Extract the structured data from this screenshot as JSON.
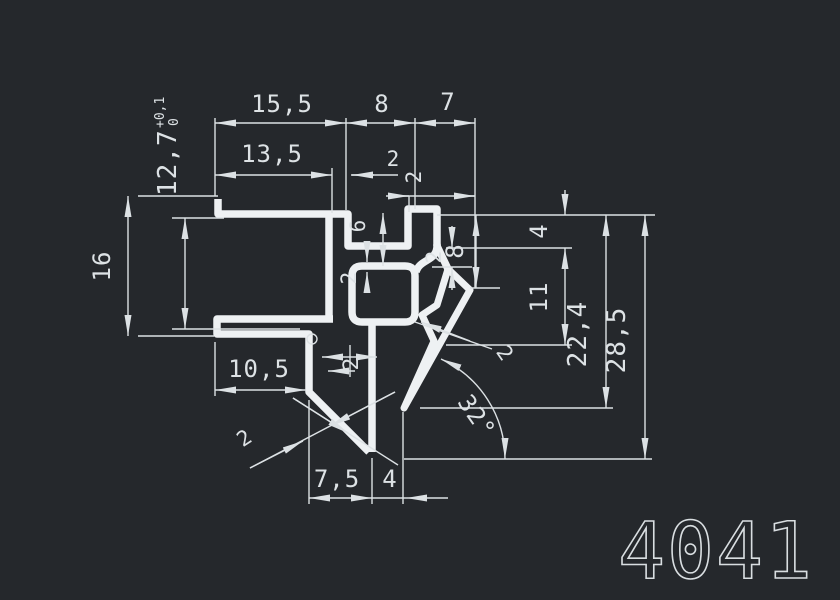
{
  "drawing": {
    "part_number": "4041",
    "colors": {
      "background": "#25282c",
      "lines": "#eef1f3",
      "text": "#dde2e5"
    },
    "top_dims": {
      "width_total": "15,5",
      "width_step": "8",
      "width_hook": "7",
      "width_inner": "13,5",
      "wall_step": "2",
      "wall_hook": "2"
    },
    "left_dims": {
      "outer_height": "16",
      "opening_nominal": "12,7",
      "opening_tol_upper": "+0,1",
      "opening_tol_lower": "0"
    },
    "mid_dims": {
      "notch_depth": "6",
      "pocket_wall": "2",
      "center_wall": "2"
    },
    "right_dims": {
      "drop_top": "4",
      "hook_depth": "8",
      "hook_wall": "2",
      "barb_depth": "11",
      "spike_depth": "22,4",
      "total_depth": "28,5",
      "lip_wall": "2"
    },
    "bottom_dims": {
      "flange_width": "10,5",
      "spike_width": "7,5",
      "tip_offset": "4",
      "v_wall": "2",
      "lip_angle": "32°"
    }
  }
}
